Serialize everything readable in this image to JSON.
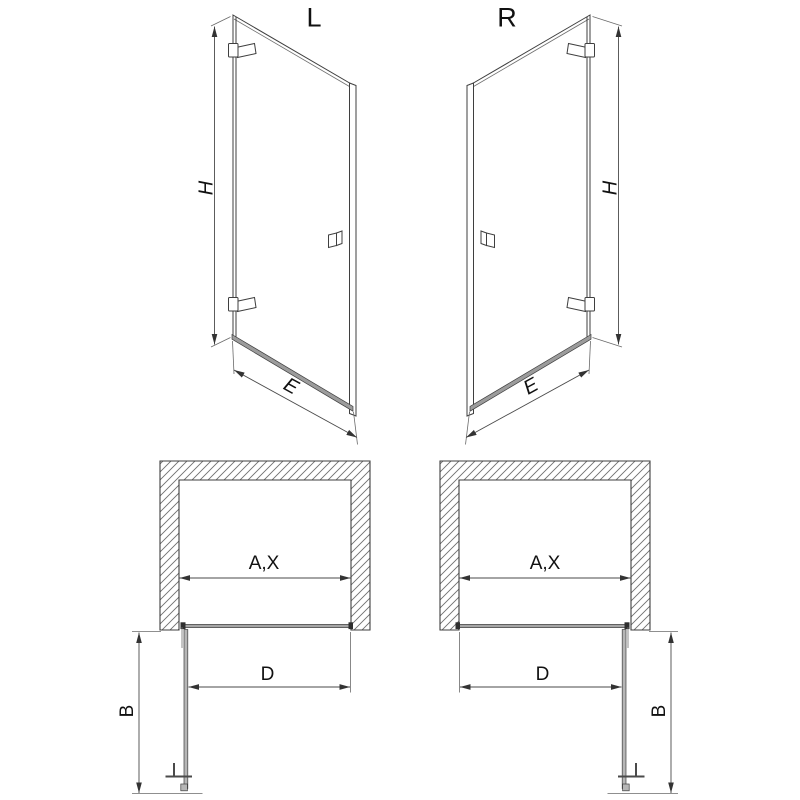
{
  "views": {
    "left_door": {
      "label": "L",
      "dims": {
        "height": "H",
        "width": "E"
      }
    },
    "right_door": {
      "label": "R",
      "dims": {
        "height": "H",
        "width": "E"
      }
    },
    "left_plan": {
      "dims": {
        "opening": "A,X",
        "clear_passage": "D",
        "door_depth": "B"
      }
    },
    "right_plan": {
      "dims": {
        "opening": "A,X",
        "clear_passage": "D",
        "door_depth": "B"
      }
    }
  },
  "colors": {
    "background": "#ffffff",
    "line": "#3f3f3f",
    "dimension_line": "#4a4a4a",
    "rail_fill": "#9c9c9c",
    "open_door_fill": "#b6b6b6",
    "text": "#111111"
  }
}
